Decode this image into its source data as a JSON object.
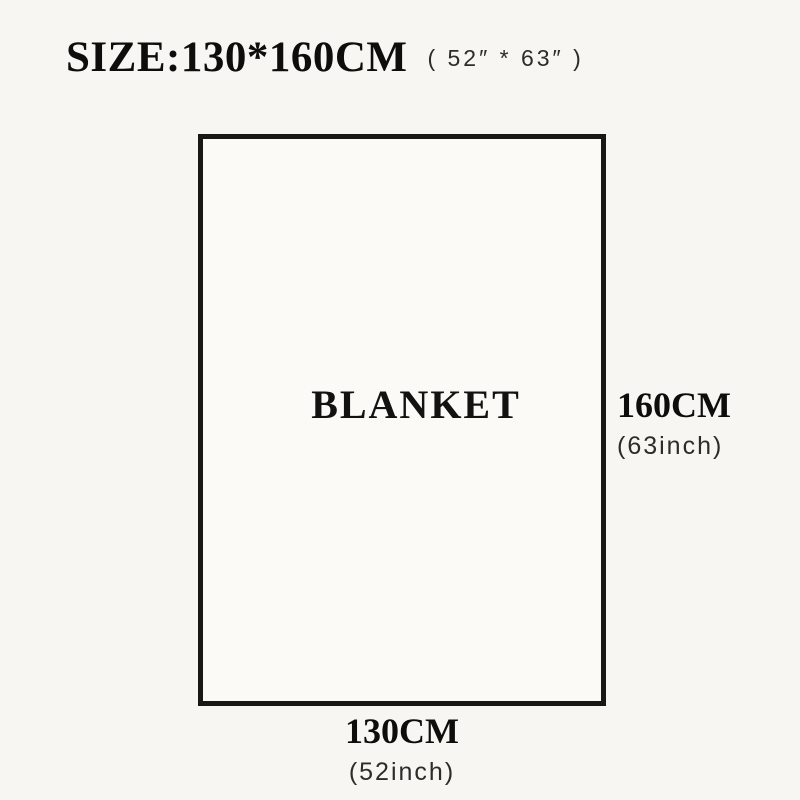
{
  "title": {
    "main": "SIZE:130*160CM",
    "inches": "( 52″ * 63″ )"
  },
  "blanket": {
    "label": "BLANKET"
  },
  "dimensions": {
    "height": {
      "cm": "160CM",
      "inch": "(63inch)"
    },
    "width": {
      "cm": "130CM",
      "inch": "(52inch)"
    }
  },
  "colors": {
    "background": "#f8f6f2",
    "outline": "#191814",
    "text_primary": "#0e0d0b",
    "text_secondary": "#2d2c29"
  }
}
